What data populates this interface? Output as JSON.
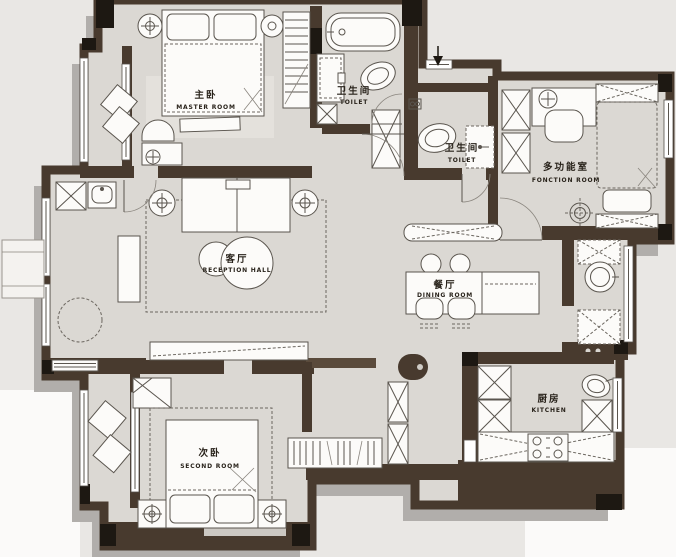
{
  "plan": {
    "title": "apartment-floor-plan",
    "rooms": [
      {
        "id": "master",
        "zh": "主卧",
        "en": "MASTER ROOM"
      },
      {
        "id": "toilet_top",
        "zh": "卫生间",
        "en": "TOILET"
      },
      {
        "id": "toilet_mid",
        "zh": "卫生间",
        "en": "TOILET"
      },
      {
        "id": "function",
        "zh": "多功能室",
        "en": "FONCTION ROOM"
      },
      {
        "id": "reception",
        "zh": "客厅",
        "en": "RECEPTION HALL"
      },
      {
        "id": "dining",
        "zh": "餐厅",
        "en": "DINING ROOM"
      },
      {
        "id": "second",
        "zh": "次卧",
        "en": "SECOND ROOM"
      },
      {
        "id": "kitchen",
        "zh": "厨房",
        "en": "KITCHEN"
      }
    ],
    "colors": {
      "background": "#e9e7e4",
      "floor": "#dbd8d3",
      "wall": "#483a2e",
      "wall_accent": "#1d1812",
      "shadow": "#b1aeab",
      "furniture": "#fcfbf9",
      "label_text": "#28221a"
    }
  }
}
